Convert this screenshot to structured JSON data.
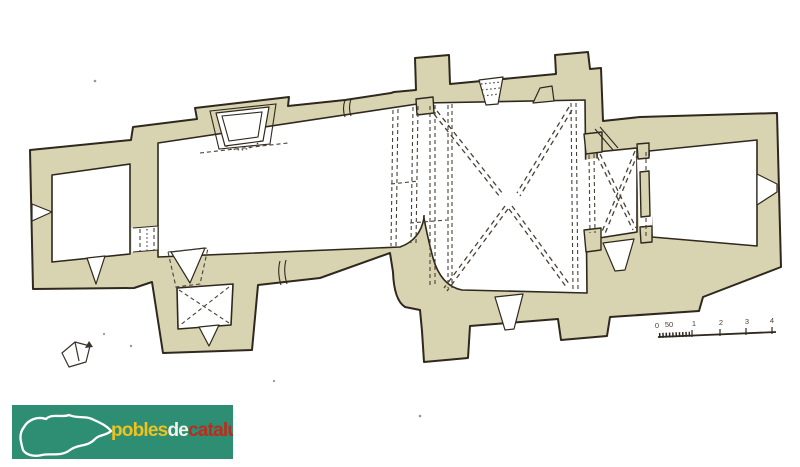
{
  "page": {
    "background": "#ffffff"
  },
  "plan": {
    "type": "architectural-floor-plan",
    "subject": "church-floor-plan",
    "wall_fill": "#d8d3b0",
    "outline_color": "#2f281e",
    "room_fill": "#ffffff",
    "vault_line_style": "dashed"
  },
  "scale_bar": {
    "labels": [
      "0",
      "50",
      "1",
      "2",
      "3",
      "4"
    ],
    "color": "#553a2c"
  },
  "logo": {
    "background": "#2e8e74",
    "map_color": "#ffffff",
    "words": [
      {
        "text": "pobles",
        "color": "#f0c21a"
      },
      {
        "text": "de",
        "color": "#f4f3ea"
      },
      {
        "text": "catalunya",
        "color": "#bf2a1a"
      }
    ]
  }
}
